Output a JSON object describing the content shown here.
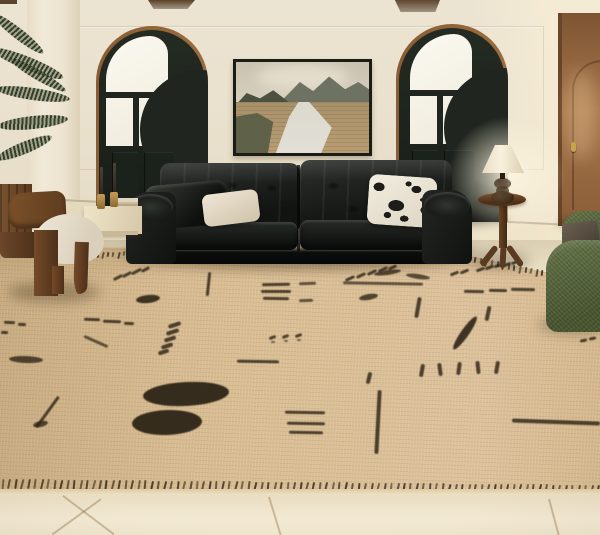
{
  "scene": {
    "type": "living-room interior photograph",
    "lighting": "warm daylight entering from the right",
    "elements": [
      "cream plaster wall with panel molding",
      "two arched black-framed glass doors",
      "framed mountain landscape painting",
      "black leather sofa with pillows",
      "beige rug with black tribal marks",
      "wood pedestal side table with lamp",
      "green boucle armchair",
      "walnut accent chair with cream seat",
      "potted palm plant",
      "travertine console with candlesticks",
      "brown wooden door",
      "cream stone tile floor"
    ]
  },
  "palette": {
    "wall": "#e9e0cc",
    "beam": "#5a4026",
    "arch_trim": "#8a5c34",
    "arch_door": "#20261f",
    "glass": "#f6f2e4",
    "painting_frame": "#1c1c17",
    "sky": "#cdc5b4",
    "mountain": "#6d7262",
    "field": "#b3986c",
    "river": "#dcd8cd",
    "brown_door": "#96683f",
    "sofa_leather": "#171917",
    "pillow_cream": "#e8dfcd",
    "pillow_floral_bg": "#f0ebdf",
    "pillow_floral_pattern": "#1c1c19",
    "lamp_shade": "#f4ecd8",
    "table_wood": "#54361e",
    "green_chair": "#5a693d",
    "chair_wood": "#6f4826",
    "chair_seat": "#ebe3d1",
    "plant": "#47523b",
    "planter": "#6d4a2b",
    "tile": "#f0e7cf",
    "rug": "#d7ba8e",
    "rug_mark": "#2e2517",
    "grout": "rgba(140,110,70,0.4)"
  },
  "painting": {
    "subject": "mountains with river through wheat fields",
    "frame": "thin black"
  },
  "sofa": {
    "type": "black leather two-section sofa",
    "pillows": [
      "black leather",
      "cream",
      "white-black botanical print"
    ]
  },
  "rug": {
    "base_color": "#d7ba8e",
    "mark_color": "#2e2517",
    "marks": [
      {
        "x": 113,
        "y": 276,
        "w": 10,
        "h": 3,
        "r": -28
      },
      {
        "x": 122,
        "y": 273,
        "w": 10,
        "h": 3,
        "r": -28
      },
      {
        "x": 131,
        "y": 270,
        "w": 11,
        "h": 3,
        "r": -28
      },
      {
        "x": 141,
        "y": 268,
        "w": 9,
        "h": 3,
        "r": -28
      },
      {
        "x": 136,
        "y": 295,
        "w": 24,
        "h": 8,
        "r": -6,
        "b": 1,
        "o": 0.9
      },
      {
        "x": 262,
        "y": 283,
        "w": 28,
        "h": 2.5,
        "r": -1
      },
      {
        "x": 261,
        "y": 290,
        "w": 30,
        "h": 2.5,
        "r": 0
      },
      {
        "x": 263,
        "y": 297,
        "w": 26,
        "h": 2.5,
        "r": 1
      },
      {
        "x": 345,
        "y": 277,
        "w": 10,
        "h": 3,
        "r": -25
      },
      {
        "x": 356,
        "y": 274,
        "w": 10,
        "h": 3,
        "r": -25
      },
      {
        "x": 367,
        "y": 271,
        "w": 10,
        "h": 3,
        "r": -25
      },
      {
        "x": 378,
        "y": 268,
        "w": 10,
        "h": 3,
        "r": -25
      },
      {
        "x": 388,
        "y": 266,
        "w": 9,
        "h": 3,
        "r": -25
      },
      {
        "x": 450,
        "y": 272,
        "w": 9,
        "h": 3,
        "r": -22
      },
      {
        "x": 460,
        "y": 270,
        "w": 9,
        "h": 3,
        "r": -22
      },
      {
        "x": 343,
        "y": 282,
        "w": 80,
        "h": 2.5,
        "r": 1,
        "o": 0.7
      },
      {
        "x": 207,
        "y": 272,
        "w": 2.5,
        "h": 24,
        "r": 6
      },
      {
        "x": 84,
        "y": 318,
        "w": 16,
        "h": 3,
        "r": 2
      },
      {
        "x": 103,
        "y": 320,
        "w": 18,
        "h": 3,
        "r": 2
      },
      {
        "x": 124,
        "y": 322,
        "w": 10,
        "h": 3,
        "r": 2
      },
      {
        "x": 4,
        "y": 321,
        "w": 11,
        "h": 3,
        "r": 2
      },
      {
        "x": 18,
        "y": 323,
        "w": 8,
        "h": 3,
        "r": 2
      },
      {
        "x": 1,
        "y": 331,
        "w": 7,
        "h": 3,
        "r": 2
      },
      {
        "x": 9,
        "y": 356,
        "w": 34,
        "h": 7,
        "r": 2,
        "b": 1,
        "o": 0.8
      },
      {
        "x": 83,
        "y": 340,
        "w": 26,
        "h": 2.5,
        "r": 24,
        "o": 0.7
      },
      {
        "x": 168,
        "y": 323,
        "w": 13,
        "h": 3.5,
        "r": -18
      },
      {
        "x": 166,
        "y": 330,
        "w": 13,
        "h": 3.5,
        "r": -18
      },
      {
        "x": 164,
        "y": 337,
        "w": 12,
        "h": 3.5,
        "r": -18
      },
      {
        "x": 161,
        "y": 344,
        "w": 12,
        "h": 3.5,
        "r": -18
      },
      {
        "x": 158,
        "y": 350,
        "w": 11,
        "h": 3.5,
        "r": -18
      },
      {
        "x": 269,
        "y": 336,
        "w": 7,
        "h": 3,
        "r": -20
      },
      {
        "x": 282,
        "y": 335,
        "w": 7,
        "h": 3,
        "r": -20
      },
      {
        "x": 295,
        "y": 334,
        "w": 7,
        "h": 3,
        "r": -20
      },
      {
        "x": 271,
        "y": 341,
        "w": 4,
        "h": 2,
        "r": 0,
        "o": 0.6
      },
      {
        "x": 284,
        "y": 340,
        "w": 4,
        "h": 2,
        "r": 0,
        "o": 0.6
      },
      {
        "x": 297,
        "y": 339,
        "w": 4,
        "h": 2,
        "r": 0,
        "o": 0.6
      },
      {
        "x": 299,
        "y": 282,
        "w": 17,
        "h": 2.5,
        "r": -2,
        "o": 0.7
      },
      {
        "x": 299,
        "y": 299,
        "w": 14,
        "h": 2.5,
        "r": -2,
        "o": 0.7
      },
      {
        "x": 359,
        "y": 294,
        "w": 19,
        "h": 6,
        "r": -10,
        "b": 1,
        "o": 0.8
      },
      {
        "x": 374,
        "y": 270,
        "w": 27,
        "h": 5,
        "r": -8,
        "b": 1,
        "o": 0.8
      },
      {
        "x": 406,
        "y": 274,
        "w": 24,
        "h": 5,
        "r": 8,
        "b": 1,
        "o": 0.75
      },
      {
        "x": 416,
        "y": 297,
        "w": 3.5,
        "h": 21,
        "r": 10
      },
      {
        "x": 461,
        "y": 313,
        "w": 8,
        "h": 40,
        "r": 35,
        "b": 1,
        "o": 0.9
      },
      {
        "x": 476,
        "y": 268,
        "w": 9,
        "h": 3,
        "r": -20
      },
      {
        "x": 485,
        "y": 266,
        "w": 9,
        "h": 3,
        "r": -20
      },
      {
        "x": 494,
        "y": 264,
        "w": 9,
        "h": 3,
        "r": -20
      },
      {
        "x": 503,
        "y": 263,
        "w": 8,
        "h": 3,
        "r": -20
      },
      {
        "x": 511,
        "y": 261,
        "w": 8,
        "h": 3,
        "r": -20
      },
      {
        "x": 464,
        "y": 290,
        "w": 20,
        "h": 2.5,
        "r": 1
      },
      {
        "x": 489,
        "y": 289,
        "w": 18,
        "h": 2.5,
        "r": 1
      },
      {
        "x": 511,
        "y": 288,
        "w": 24,
        "h": 2.5,
        "r": 1
      },
      {
        "x": 486,
        "y": 306,
        "w": 4,
        "h": 15,
        "r": 12
      },
      {
        "x": 548,
        "y": 313,
        "w": 9,
        "h": 3,
        "r": -12
      },
      {
        "x": 559,
        "y": 311,
        "w": 9,
        "h": 3,
        "r": -12
      },
      {
        "x": 566,
        "y": 328,
        "w": 8,
        "h": 3,
        "r": -12
      },
      {
        "x": 576,
        "y": 326,
        "w": 8,
        "h": 3,
        "r": -12
      },
      {
        "x": 585,
        "y": 324,
        "w": 8,
        "h": 3,
        "r": -12
      },
      {
        "x": 580,
        "y": 339,
        "w": 7,
        "h": 3,
        "r": -12
      },
      {
        "x": 589,
        "y": 337,
        "w": 7,
        "h": 3,
        "r": -12
      },
      {
        "x": 237,
        "y": 360,
        "w": 42,
        "h": 3,
        "r": 1
      },
      {
        "x": 420,
        "y": 364,
        "w": 4,
        "h": 13,
        "r": 10
      },
      {
        "x": 438,
        "y": 363,
        "w": 4,
        "h": 13,
        "r": -8
      },
      {
        "x": 457,
        "y": 362,
        "w": 4,
        "h": 13,
        "r": 8
      },
      {
        "x": 476,
        "y": 361,
        "w": 4,
        "h": 13,
        "r": -6
      },
      {
        "x": 495,
        "y": 361,
        "w": 4,
        "h": 13,
        "r": 10
      },
      {
        "x": 367,
        "y": 372,
        "w": 4,
        "h": 12,
        "r": 14
      },
      {
        "x": 376,
        "y": 390,
        "w": 4,
        "h": 64,
        "r": 3
      },
      {
        "x": 285,
        "y": 411,
        "w": 40,
        "h": 3,
        "r": 1
      },
      {
        "x": 287,
        "y": 422,
        "w": 38,
        "h": 3,
        "r": 1
      },
      {
        "x": 289,
        "y": 431,
        "w": 34,
        "h": 3,
        "r": 1
      },
      {
        "x": 512,
        "y": 420,
        "w": 88,
        "h": 4,
        "r": 2
      },
      {
        "x": 46,
        "y": 393,
        "w": 3,
        "h": 38,
        "r": 36
      },
      {
        "x": 33,
        "y": 421,
        "w": 15,
        "h": 6,
        "r": -12,
        "b": 1,
        "o": 0.8
      },
      {
        "x": 143,
        "y": 382,
        "w": 86,
        "h": 24,
        "r": -3,
        "b": 1,
        "o": 0.95
      },
      {
        "x": 132,
        "y": 410,
        "w": 70,
        "h": 25,
        "r": -2,
        "b": 1,
        "o": 0.95
      }
    ],
    "top_border_segments": [
      {
        "x1": 86,
        "y1": 253,
        "x2": 128,
        "y2": 251,
        "n": 9,
        "h": 5
      },
      {
        "x1": 452,
        "y1": 252,
        "x2": 597,
        "y2": 282,
        "n": 27,
        "h": 6
      }
    ],
    "bottom_border": {
      "x1": 2,
      "y1": 479,
      "x2": 597,
      "y2": 485,
      "n": 93,
      "h": 10
    },
    "binding_color": "#e9dfc6"
  },
  "floor": {
    "tile_color": "#f0e7cf",
    "grout_lines": [
      {
        "x": 62,
        "y": 496,
        "len": 64,
        "rot": -53
      },
      {
        "x": 100,
        "y": 499,
        "len": 60,
        "rot": 54
      },
      {
        "x": 268,
        "y": 497,
        "len": 40,
        "rot": -17
      },
      {
        "x": 548,
        "y": 499,
        "len": 38,
        "rot": -15
      }
    ]
  }
}
